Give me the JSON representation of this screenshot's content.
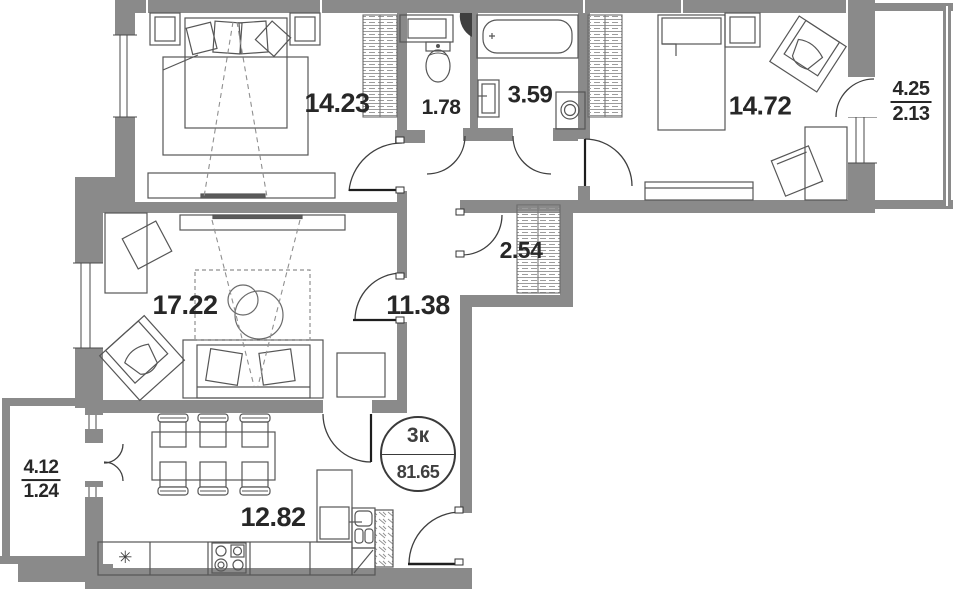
{
  "plan": {
    "title": "3-room apartment floor plan",
    "badge": {
      "rooms_label": "3к",
      "total_area": "81.65"
    },
    "rooms": {
      "bedroom_1": {
        "area": "14.23"
      },
      "toilet": {
        "area": "1.78"
      },
      "bathroom": {
        "area": "3.59"
      },
      "bedroom_2": {
        "area": "14.72"
      },
      "balcony_right": {
        "area_full": "4.25",
        "area_reduced": "2.13"
      },
      "living_room": {
        "area": "17.22"
      },
      "hallway": {
        "area": "11.38"
      },
      "storage": {
        "area": "2.54"
      },
      "kitchen": {
        "area": "12.82"
      },
      "balcony_left": {
        "area_full": "4.12",
        "area_reduced": "1.24"
      }
    },
    "icons": {
      "freezer_symbol": "✳"
    },
    "colors": {
      "wall": "#8a8a8a",
      "furniture_line": "#565656",
      "text": "#272727",
      "hatch": "#9c9c9c"
    }
  }
}
